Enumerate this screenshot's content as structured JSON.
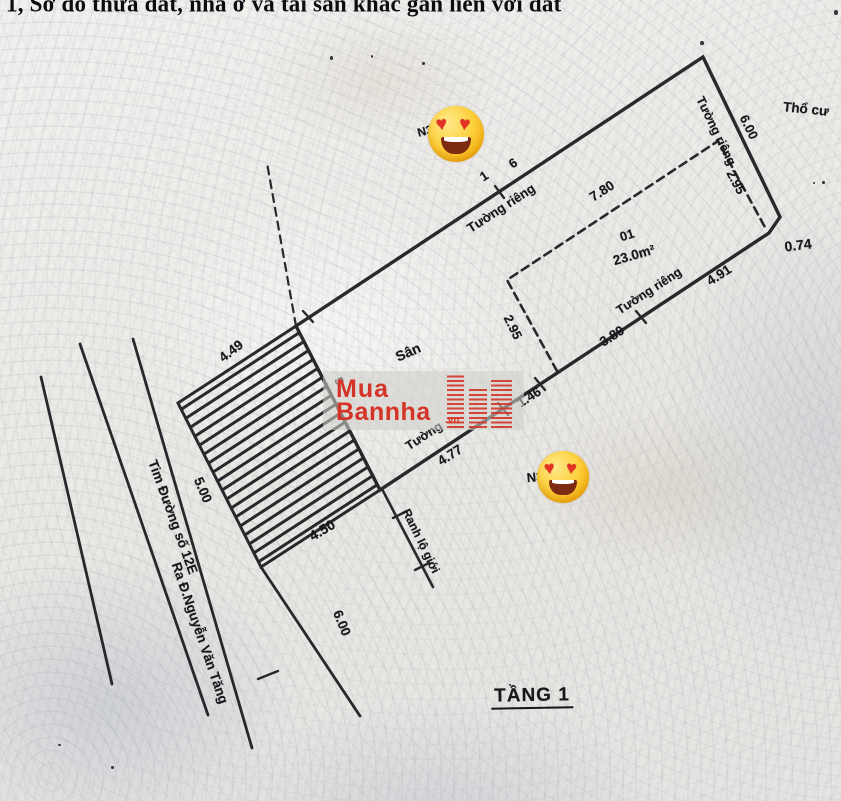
{
  "title": "1, Sơ đồ thửa đất, nhà ở và tài sản khác gắn liền với đất",
  "diagram": {
    "wall_top_label": "Tường riêng",
    "point_1": "1",
    "point_6": "6",
    "wall_right_label": "Tường riêng",
    "dim_right_wall": "6.00",
    "land_type": "Thổ cư",
    "dim_house_right": "2.95",
    "dim_house_front": "7.80",
    "house_number": "01",
    "house_area": "23.0m²",
    "dim_house_left": "2.95",
    "dim_notch": "0.74",
    "wall_se_label": "Tường riêng",
    "dim_seg1": "4.91",
    "dim_seg2": "3.89",
    "dim_seg3": "1.46",
    "wall_se2_label": "Tường",
    "dim_seg4": "4.77",
    "yard_label": "Sân",
    "dim_hatch_nw": "4.49",
    "dim_hatch_sw": "5.00",
    "dim_hatch_se": "4.50",
    "dim_hatch_ne": "5",
    "road_boundary_label": "Ranh lộ giới",
    "dim_road_width": "6.00",
    "road_centerline_label": "Tim Đường số 12E",
    "road_direction_label": "Ra Đ.Nguyễn Văn Tăng",
    "marker_1": "N3",
    "marker_2": "N3",
    "floor_label": "TẦNG 1"
  },
  "watermark": {
    "line1": "Mua",
    "line2": "Bannha",
    "suffix": ".vn"
  },
  "emoji": {
    "name": "heart-eyes",
    "heart_char": "♥"
  }
}
